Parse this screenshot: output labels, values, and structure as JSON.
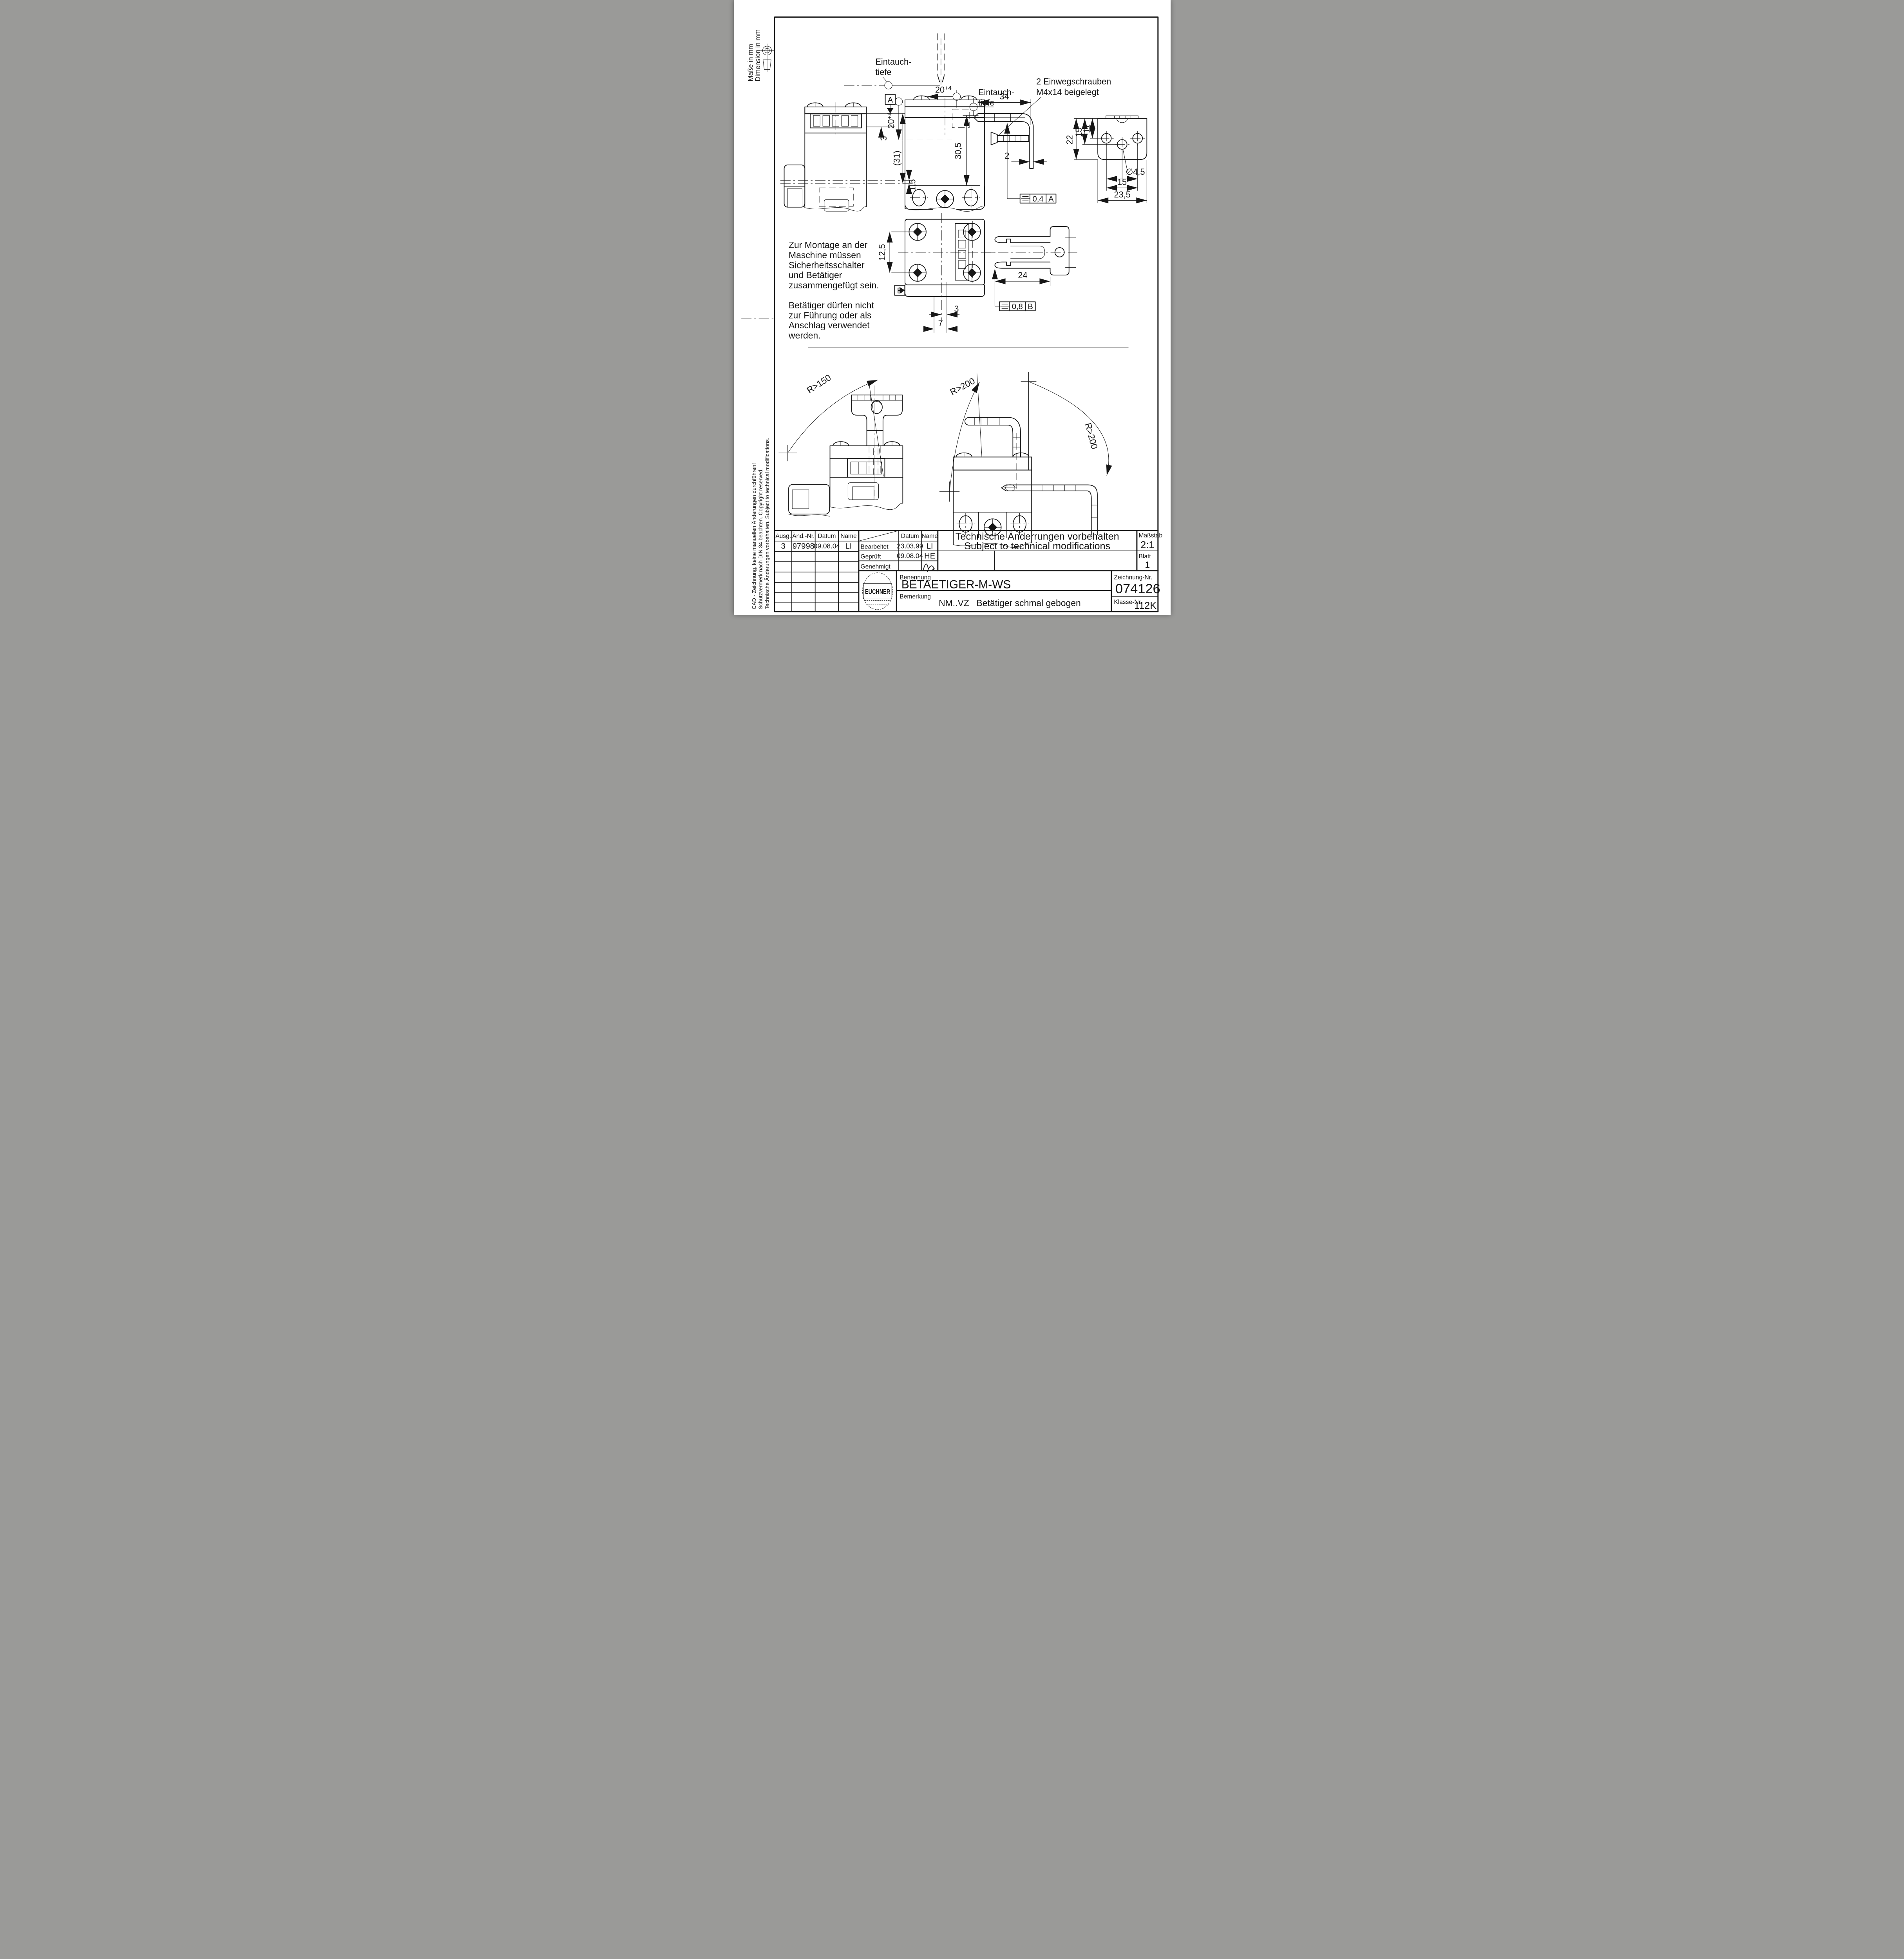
{
  "page": {
    "paper": "#ffffff",
    "ink": "#161616"
  },
  "margin": {
    "units_de": "Maße in mm",
    "units_en": "Dimension in mm",
    "cad_note": "CAD - Zeichnung, keine manuellen Änderungen durchführen!",
    "din_note": "Schutzvermerk nach DIN 34 beachten. Copyright reserved.",
    "tech_note": "Technische Änderungen vorbehalten. Subject to technical modifications."
  },
  "annotations": {
    "eintauch1": [
      "Eintauch-",
      "tiefe"
    ],
    "eintauch2": [
      "Eintauch-",
      "tiefe"
    ],
    "screws": [
      "2 Einwegschrauben",
      "M4x14 beigelegt"
    ],
    "assembly": [
      "Zur Montage an der",
      "Maschine müssen",
      "Sicherheitsschalter",
      "und Betätiger",
      "zusammengefügt sein."
    ],
    "usage": [
      "Betätiger dürfen nicht",
      "zur Führung oder als",
      "Anschlag verwendet",
      "werden."
    ]
  },
  "dims": {
    "d20a": "20",
    "d20a_tol": "+4",
    "d20b": "20",
    "d20b_tol": "+4",
    "d34": "34",
    "d30_5": "30,5",
    "d2": "2",
    "d3a": "3",
    "d31": "(31)",
    "d1_5": "1,5",
    "d22": "22",
    "d15a": "15",
    "d11": "11",
    "dia4_5": "∅4,5",
    "d15b": "15",
    "d23_5": "23,5",
    "d12_5": "12,5",
    "d3b": "3",
    "d7": "7",
    "d24": "24"
  },
  "datums": {
    "a": "A",
    "b": "B"
  },
  "frames": {
    "a_value": "0,4",
    "a_ref": "A",
    "b_value": "0,8",
    "b_ref": "B"
  },
  "radii": {
    "r150": "R>150",
    "r200a": "R>200",
    "r200b": "R>200"
  },
  "title_block": {
    "revision": {
      "headers": [
        "Ausg.",
        "Änd.-Nr.",
        "Datum",
        "Name"
      ],
      "row": [
        "3",
        "97998",
        "09.08.04",
        "LI"
      ]
    },
    "approval": {
      "datum": "Datum",
      "name": "Name",
      "rows": [
        [
          "Bearbeitet",
          "23.03.99",
          "LI"
        ],
        [
          "Geprüft",
          "09.08.04",
          "HE"
        ],
        [
          "Genehmigt",
          "",
          ""
        ]
      ]
    },
    "notice_de": "Technische Änderrungen vorbehalten",
    "notice_en": "Subject to technical modifications",
    "massstab_label": "Maßstab",
    "massstab": "2:1",
    "blatt_label": "Blatt",
    "blatt": "1",
    "logo": "EUCHNER",
    "benennung_label": "Benennung",
    "benennung": "BETAETIGER-M-WS",
    "bemerkung_label": "Bemerkung",
    "bemerkung_code": "NM..VZ",
    "bemerkung_text": "Betätiger schmal gebogen",
    "zeichnung_label": "Zeichnung-Nr.",
    "zeichnung": "074126",
    "klasse_label": "Klasse-Nr.",
    "klasse": "112K"
  }
}
